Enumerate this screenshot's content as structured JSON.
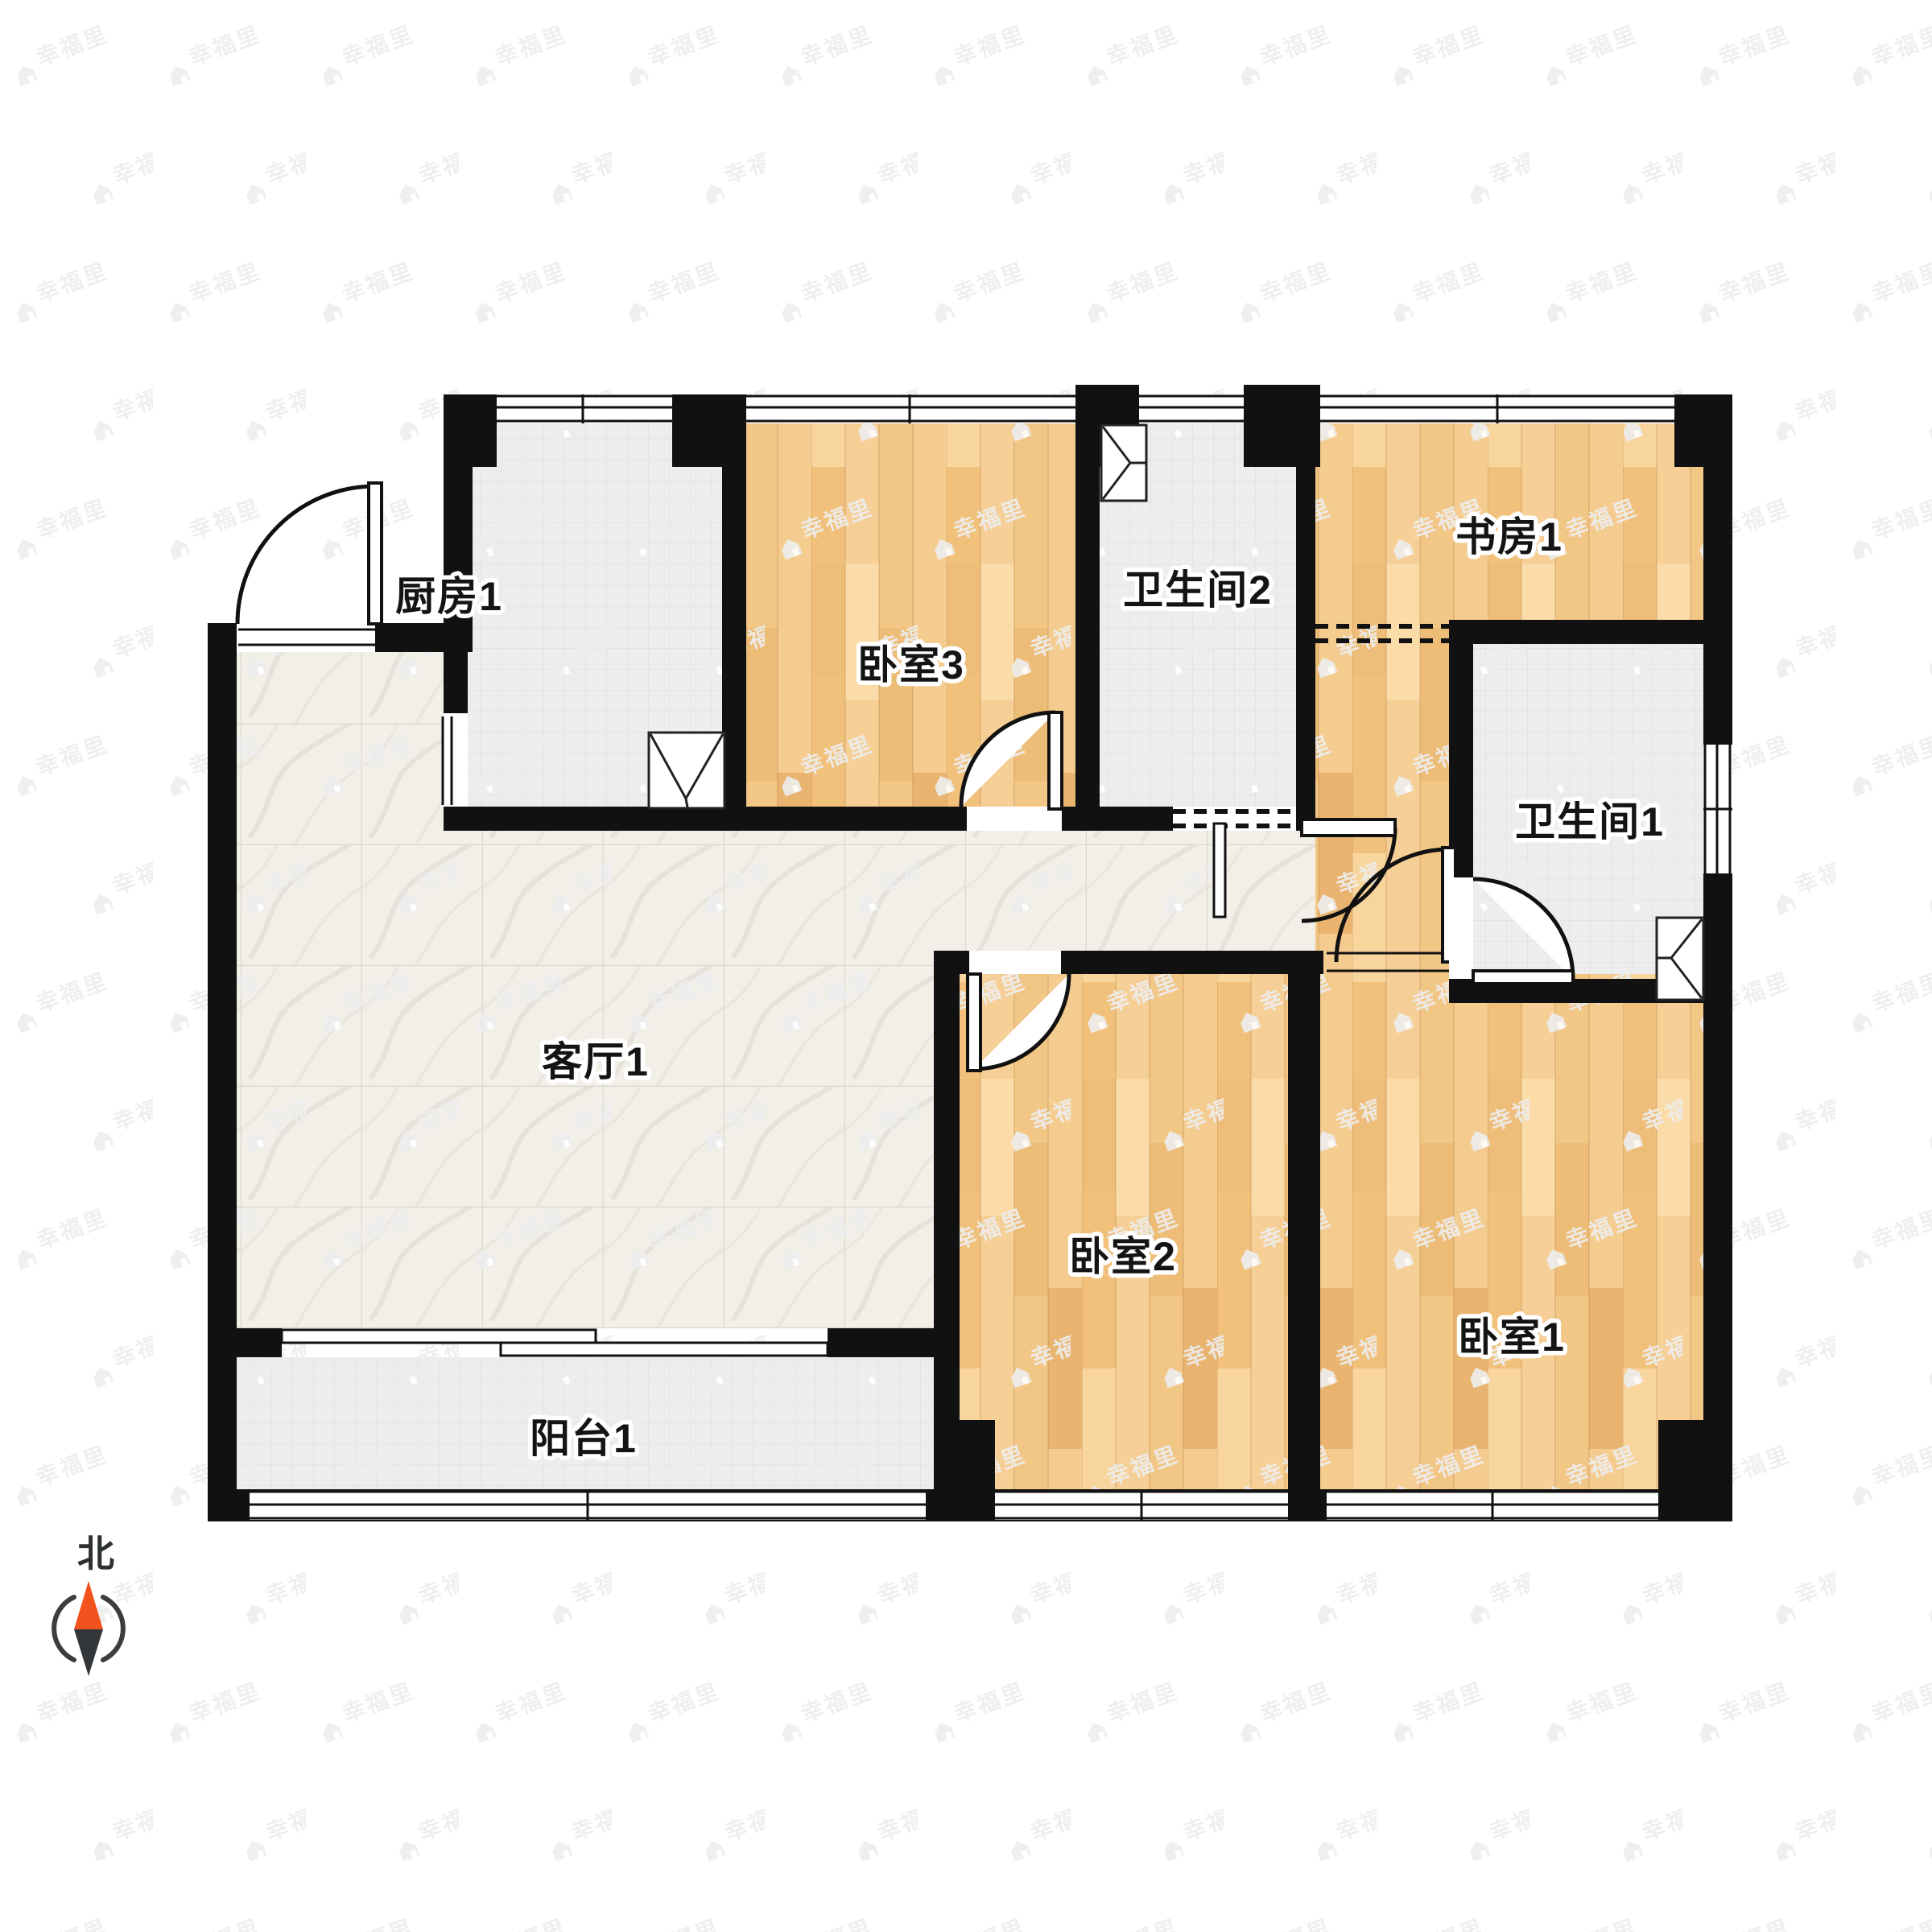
{
  "plan": {
    "rooms": [
      {
        "id": "kitchen",
        "label": "厨房1"
      },
      {
        "id": "bedroom3",
        "label": "卧室3"
      },
      {
        "id": "bathroom2",
        "label": "卫生间2"
      },
      {
        "id": "study",
        "label": "书房1"
      },
      {
        "id": "bathroom1",
        "label": "卫生间1"
      },
      {
        "id": "living",
        "label": "客厅1"
      },
      {
        "id": "bedroom2",
        "label": "卧室2"
      },
      {
        "id": "bedroom1",
        "label": "卧室1"
      },
      {
        "id": "balcony",
        "label": "阳台1"
      }
    ],
    "compass": {
      "north_label": "北"
    },
    "watermark": {
      "text": "幸福里"
    },
    "colors": {
      "wall": "#111111",
      "wood": "#f3c888",
      "tile": "#ededed",
      "marble": "#f2efe9",
      "watermark_gray": "#ededee",
      "compass_north": "#F2521E",
      "compass_south": "#33373A",
      "label_text": "#141414"
    }
  }
}
